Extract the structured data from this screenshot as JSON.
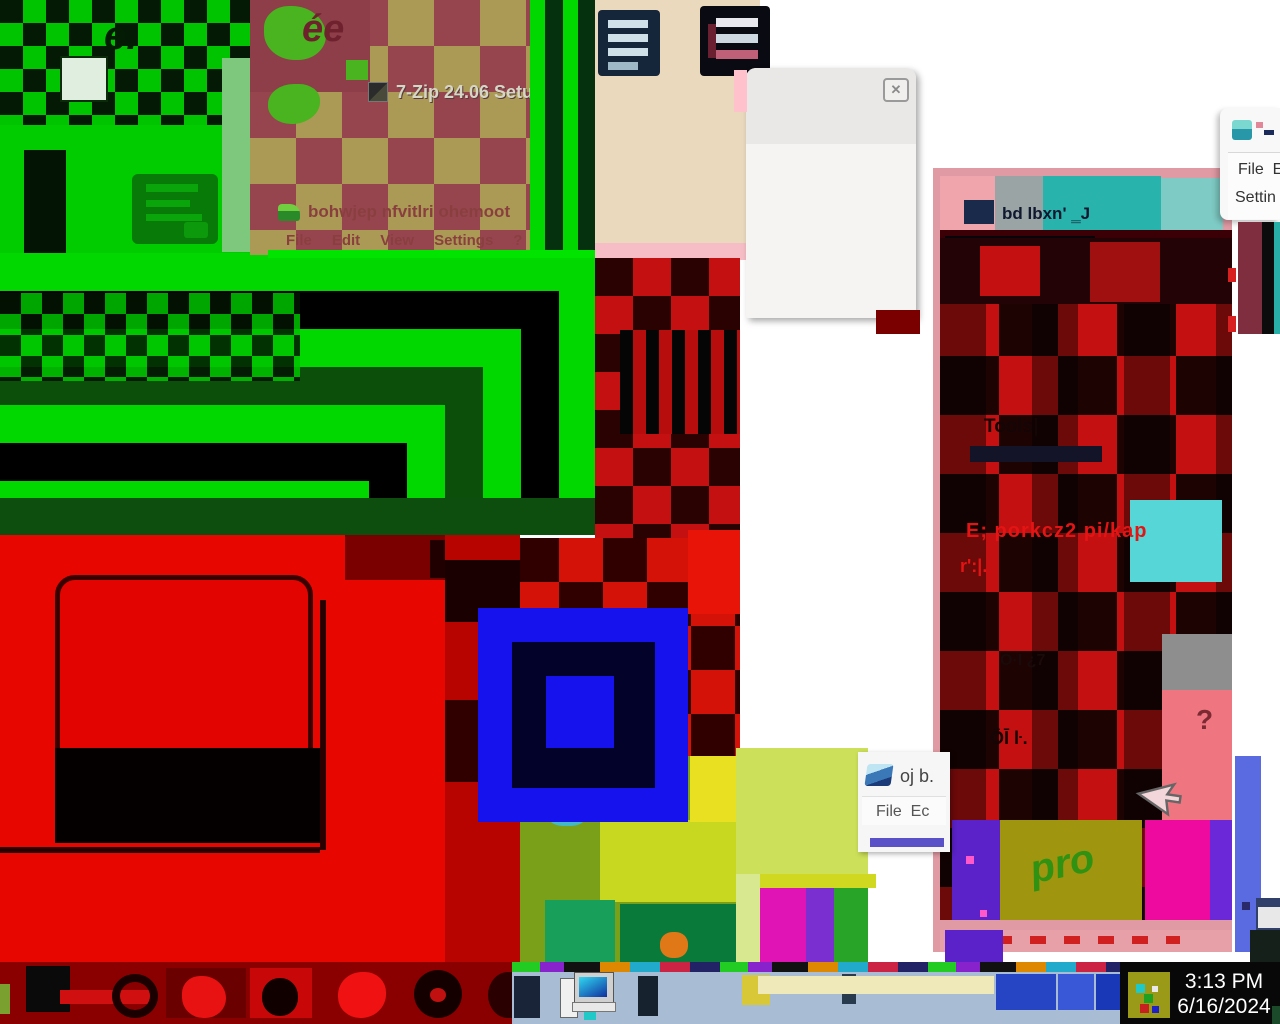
{
  "palette": {
    "bright_green": "#00d800",
    "bright_red": "#e80600",
    "bright_blue": "#1512ee",
    "magenta": "#ee0a9e",
    "teal": "#28b4ac",
    "olive": "#a0950f",
    "taskbar_gray_blue": "#a8bcd4",
    "tray_black": "#080808",
    "setup_tan": "#ab9a55",
    "setup_maroon": "#96454f"
  },
  "desktop": {
    "glyph_topleft": "e.",
    "glyph_setup_blob": "ée"
  },
  "windows": {
    "setup": {
      "title": "7-Zip 24.06 Setup"
    },
    "archive": {
      "title": "bohwjep nfvitlri ohemoot",
      "menu": [
        {
          "label": "File"
        },
        {
          "label": "Edit"
        },
        {
          "label": "View"
        },
        {
          "label": "Settings"
        },
        {
          "label": "?"
        }
      ]
    },
    "floating_controls": {
      "minimize": "▬",
      "maximize": "▣",
      "close": "✕"
    },
    "white_dialog": {
      "close": "✕"
    },
    "right_large": {
      "title_glyphs": "bd lbxn' ‗J",
      "tools": "Tools|",
      "path_line": "E; porkcz2 pi/kap",
      "frag1": "r':|.",
      "frag2": "O·I ¿7",
      "frag3": "ŌĪ ŀ.",
      "question": "?",
      "pro": "pro",
      "specks": "¡·¦=¡ ·"
    },
    "right_partial": {
      "menu_line1": "File  E",
      "menu_line2": "Settin"
    },
    "mini": {
      "title": "oj b.",
      "menu_line": "File  Ec"
    }
  },
  "taskbar": {
    "clock_time": "3:13 PM",
    "clock_date": "6/16/2024"
  }
}
